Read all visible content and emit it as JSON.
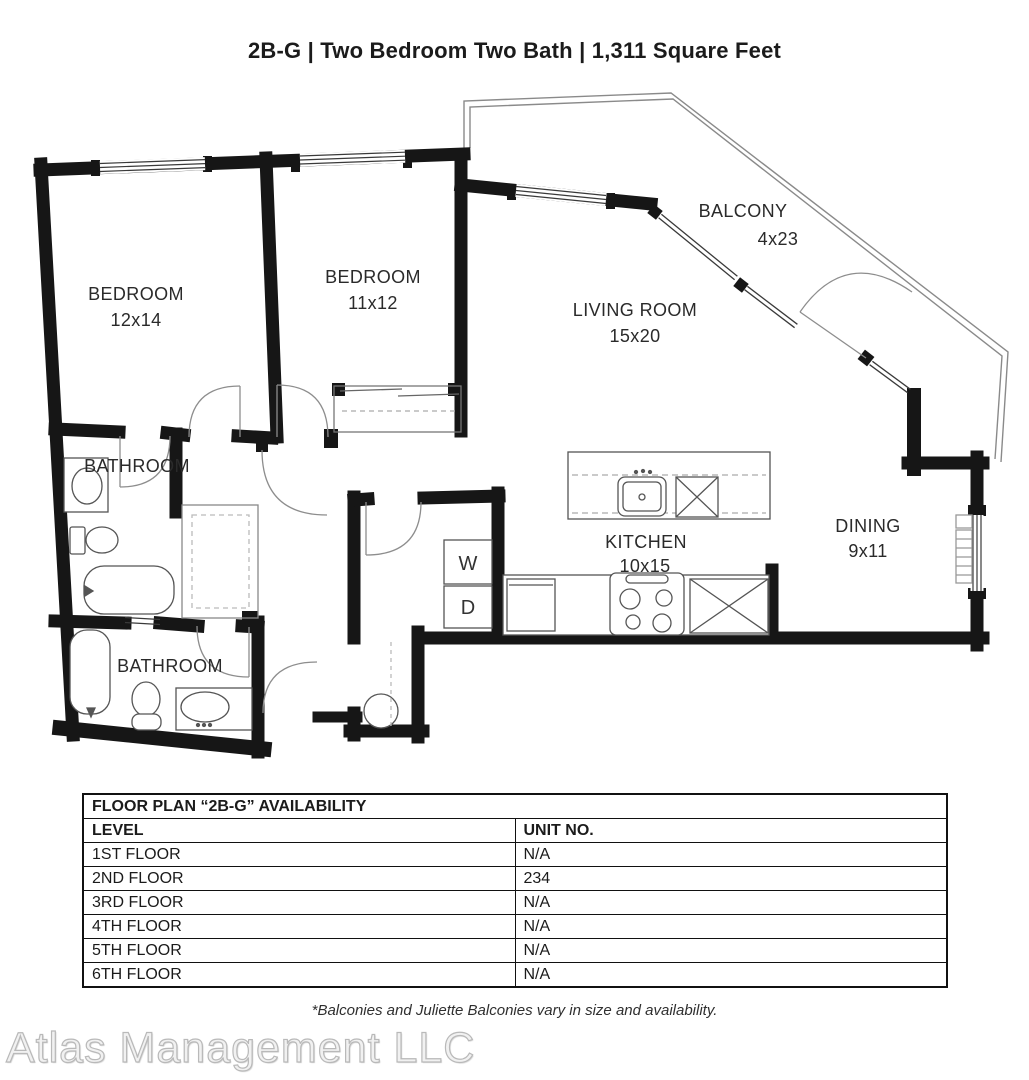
{
  "title": "2B-G | Two Bedroom Two Bath | 1,311 Square Feet",
  "plan": {
    "washer": "W",
    "dryer": "D",
    "rooms": {
      "bedroom1": {
        "name": "BEDROOM",
        "dims": "12x14"
      },
      "bedroom2": {
        "name": "BEDROOM",
        "dims": "11x12"
      },
      "living": {
        "name": "LIVING ROOM",
        "dims": "15x20"
      },
      "balcony": {
        "name": "BALCONY",
        "dims": "4x23"
      },
      "dining": {
        "name": "DINING",
        "dims": "9x11"
      },
      "kitchen": {
        "name": "KITCHEN",
        "dims": "10x15"
      },
      "bathroom1": {
        "name": "BATHROOM"
      },
      "bathroom2": {
        "name": "BATHROOM"
      }
    }
  },
  "availability": {
    "title": "FLOOR PLAN “2B-G” AVAILABILITY",
    "columns": {
      "level": "LEVEL",
      "unit": "UNIT NO."
    },
    "rows": [
      {
        "level": "1ST FLOOR",
        "unit": "N/A"
      },
      {
        "level": "2ND FLOOR",
        "unit": "234"
      },
      {
        "level": "3RD FLOOR",
        "unit": "N/A"
      },
      {
        "level": "4TH FLOOR",
        "unit": "N/A"
      },
      {
        "level": "5TH FLOOR",
        "unit": "N/A"
      },
      {
        "level": "6TH FLOOR",
        "unit": "N/A"
      }
    ]
  },
  "footnote": "*Balconies and Juliette Balconies vary in size and availability.",
  "watermark": "Atlas Management LLC",
  "colors": {
    "wall": "#161616",
    "thin": "#555555",
    "arc": "#888888",
    "text": "#2a2a2a"
  }
}
